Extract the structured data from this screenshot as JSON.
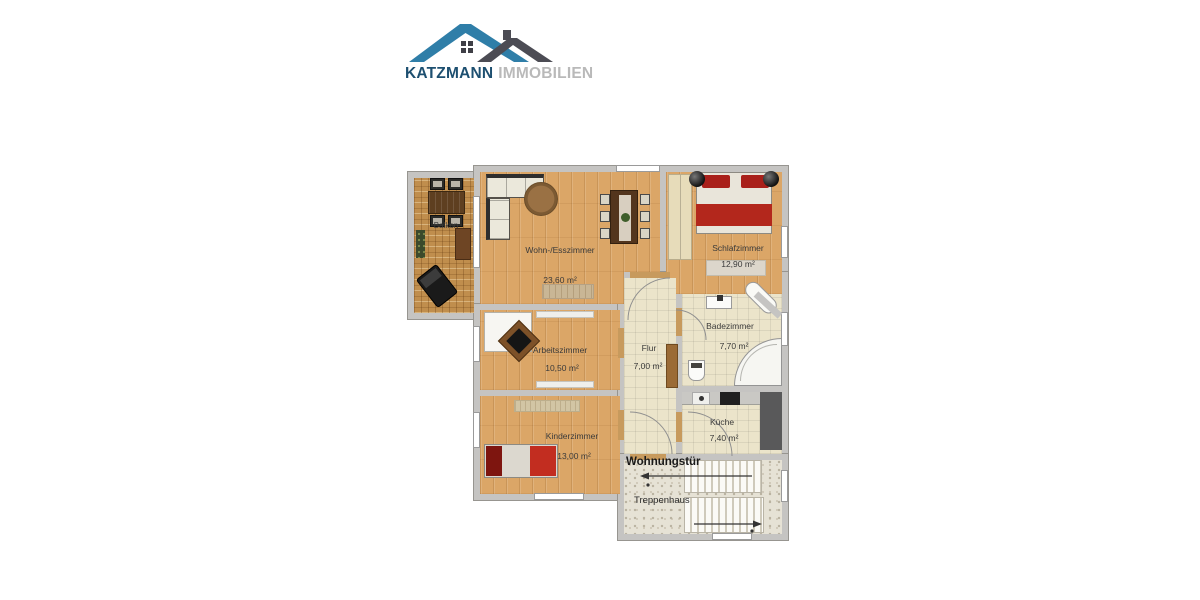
{
  "logo": {
    "brand_primary": "KATZMANN",
    "brand_secondary": "IMMOBILIEN",
    "colors": {
      "brand_primary_text": "#1d4f70",
      "brand_secondary_text": "#b9b9b9",
      "roof_blue": "#2f7ea8",
      "roof_gray": "#4c4c54"
    }
  },
  "floorplan": {
    "colors": {
      "wall": "#c5c4c2",
      "wood_floor": "#dba667",
      "balcony_wood": "#c08e4d",
      "tile_floor": "#ebe4ca",
      "stairwell_floor": "#e6e2d5",
      "accent_red": "#b3271c"
    },
    "rooms": [
      {
        "id": "balkon",
        "label": "Balkon",
        "area": ""
      },
      {
        "id": "wohnzimmer",
        "label": "Wohn-/Esszimmer",
        "area": "23,60 m²"
      },
      {
        "id": "schlafzimmer",
        "label": "Schlafzimmer",
        "area": "12,90 m²"
      },
      {
        "id": "arbeitszimmer",
        "label": "Arbeitszimmer",
        "area": "10,50 m²"
      },
      {
        "id": "kinderzimmer",
        "label": "Kinderzimmer",
        "area": "13,00 m²"
      },
      {
        "id": "flur",
        "label": "Flur",
        "area": "7,00 m²"
      },
      {
        "id": "badezimmer",
        "label": "Badezimmer",
        "area": "7,70 m²"
      },
      {
        "id": "kueche",
        "label": "Küche",
        "area": "7,40 m²"
      },
      {
        "id": "wohnungstuer",
        "label": "Wohnungstür",
        "area": ""
      },
      {
        "id": "treppenhaus",
        "label": "Treppenhaus",
        "area": ""
      }
    ]
  }
}
